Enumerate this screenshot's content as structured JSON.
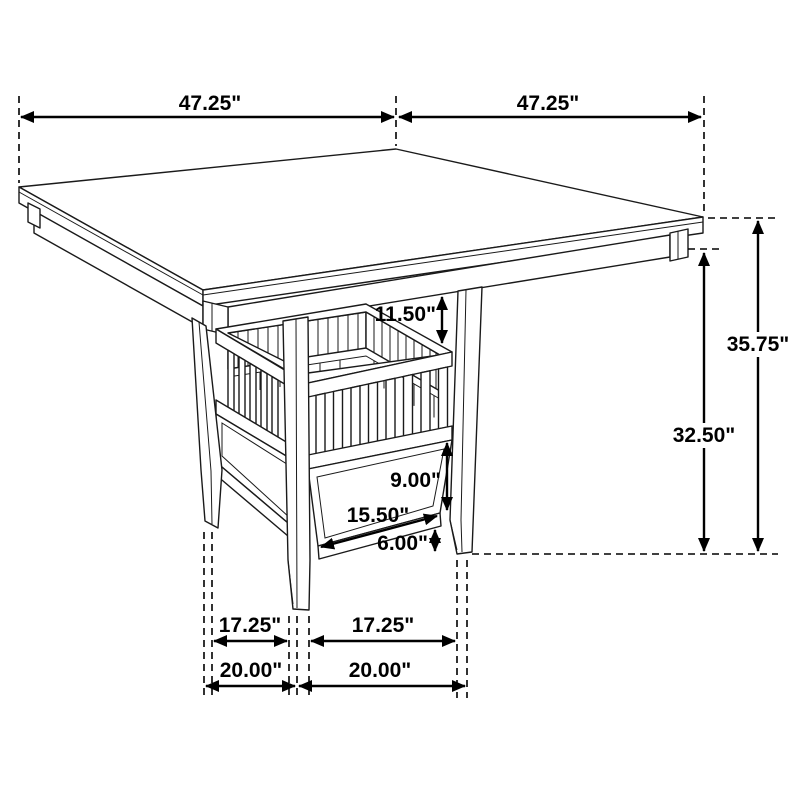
{
  "diagram": {
    "type": "furniture-dimension-drawing",
    "subject": "Square counter-height pedestal dining table with slatted storage shelf and lower drawer",
    "unit": "inches",
    "colors": {
      "line": "#000000",
      "background": "#ffffff"
    },
    "labels": {
      "width_left": "47.25\"",
      "width_right": "47.25\"",
      "overall_height": "35.75\"",
      "underside_height": "32.50\"",
      "top_to_shelf": "11.50\"",
      "panel_height": "9.00\"",
      "panel_width": "15.50\"",
      "floor_clearance": "6.00\"",
      "foot_gap_left": "17.25\"",
      "foot_gap_right": "17.25\"",
      "foot_span_left": "20.00\"",
      "foot_span_right": "20.00\""
    }
  }
}
